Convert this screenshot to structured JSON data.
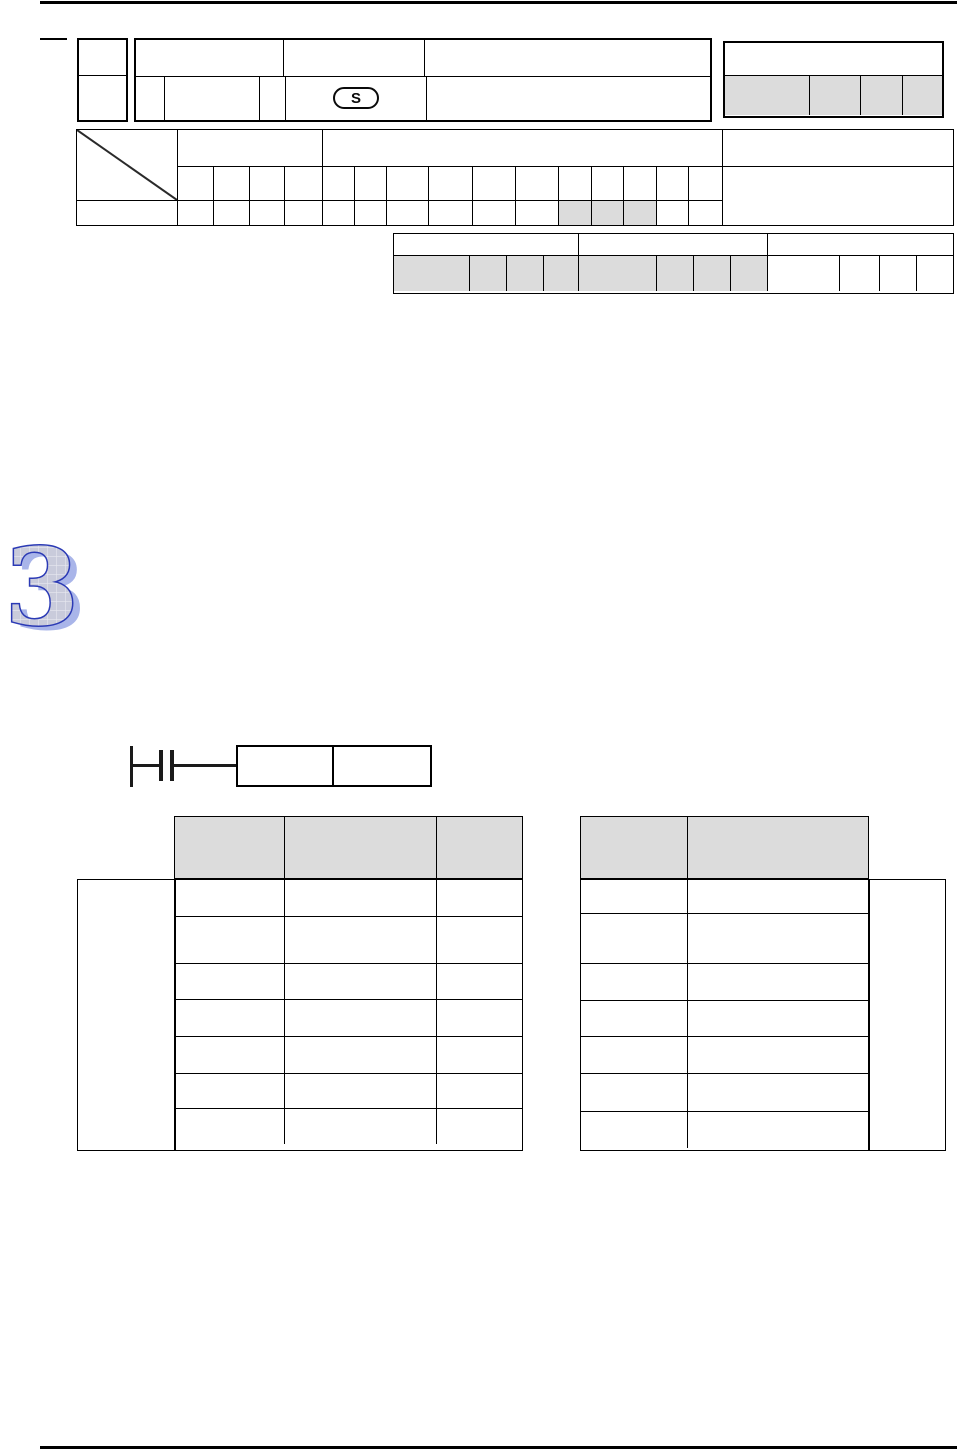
{
  "page": {
    "chapter_number": "3",
    "instruction_format": {
      "s_operand_marker": "S"
    },
    "colors": {
      "table_border": "#000000",
      "shaded_cell": "#dcdcdc",
      "chapter_numeral_fill": "#c9cbdb",
      "chapter_numeral_outline": "#2b3ab5",
      "chapter_numeral_shadow": "#a9b5e9"
    }
  }
}
